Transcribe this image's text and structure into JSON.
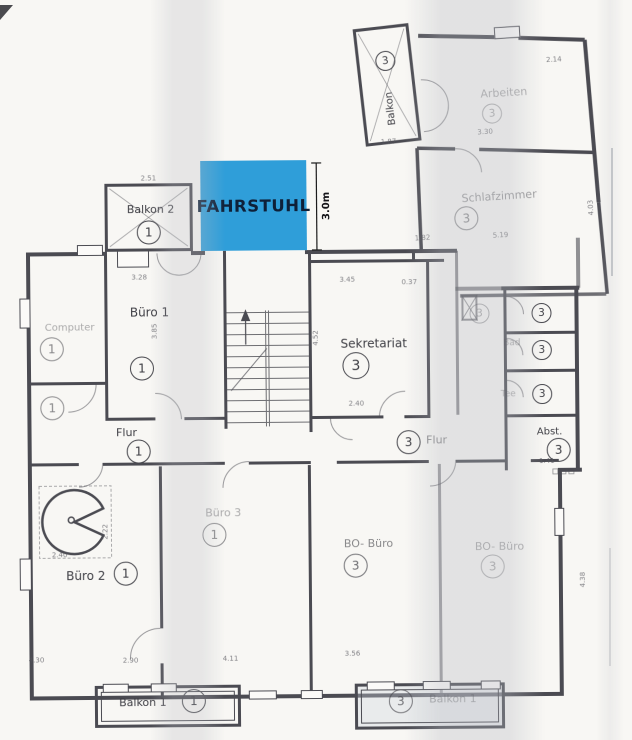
{
  "colors": {
    "elevator_fill": "#2f9ed9",
    "elevator_text": "#0e2038",
    "ink": "#4b4b52",
    "paper": "#f8f7f4"
  },
  "elevator": {
    "label": "FAHRSTUHL",
    "dimension": "3.0m"
  },
  "rooms": {
    "balkon2": {
      "label": "Balkon 2",
      "unit": "1"
    },
    "buero1": {
      "label": "Büro 1",
      "unit": "1"
    },
    "computer": {
      "label": "Computer",
      "unit": "1"
    },
    "wc1": {
      "unit": "1"
    },
    "flur1": {
      "label": "Flur",
      "unit": "1"
    },
    "buero2": {
      "label": "Büro 2",
      "unit": "1"
    },
    "buero3": {
      "label": "Büro 3",
      "unit": "1"
    },
    "balkon1": {
      "label": "Balkon 1",
      "unit": "1"
    },
    "balkon3": {
      "label": "Balkon",
      "unit": "3"
    },
    "arbeiten": {
      "label": "Arbeiten",
      "unit": "3"
    },
    "schlafzimmer": {
      "label": "Schlafzimmer",
      "unit": "3"
    },
    "sekretariat": {
      "label": "Sekretariat",
      "unit": "3"
    },
    "flur3": {
      "label": "Flur",
      "unit": "3"
    },
    "bad3": {
      "label": "Bad",
      "unit": "3"
    },
    "tee3": {
      "label": "Tee"
    },
    "kammer1": {
      "unit": "3"
    },
    "kammer2": {
      "unit": "3"
    },
    "kammer3": {
      "unit": "3"
    },
    "abst": {
      "label": "Abst.",
      "unit": "3"
    },
    "bo_buero_1": {
      "label": "BO- Büro",
      "unit": "3"
    },
    "bo_buero_2": {
      "label": "BO- Büro",
      "unit": "3"
    },
    "balkon_br": {
      "label": "Balkon 1",
      "unit": "3"
    }
  },
  "dims": [
    "3.28",
    "2.51",
    "3.45",
    "4.52",
    "2.40",
    "0.37",
    "2.14",
    "3.30",
    "1.87",
    "1.82",
    "5.19",
    "1.41",
    "4.30",
    "2.90",
    "4.11",
    "2.40",
    "2.22",
    "3.85",
    "4.03",
    "3.56",
    "4.38"
  ]
}
